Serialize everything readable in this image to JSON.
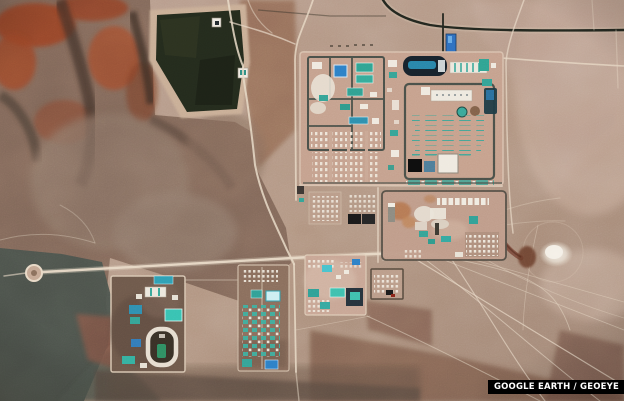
{
  "attribution": {
    "label": "GOOGLE EARTH / GEOEYE"
  },
  "palette": {
    "attribution_bg": "#000000",
    "attribution_fg": "#ffffff",
    "desert_light": "#c8ab97",
    "desert_base": "#af927f",
    "desert_dark": "#7c5c4a",
    "rock_gray": "#7e6557",
    "rock_slate": "#49504a",
    "rock_red": "#993f24",
    "pond_dark": "#242b1d",
    "road_light": "#e8d9c6",
    "road_dark": "#23271f",
    "building_teal": "#3aa89a",
    "building_blue": "#2d7fc6",
    "building_white": "#efe9df",
    "water_blue": "#2e6fc0"
  }
}
